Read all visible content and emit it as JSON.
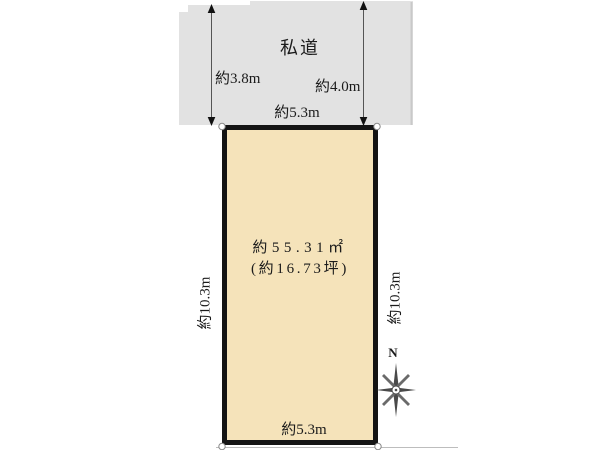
{
  "diagram": {
    "background_color": "#ffffff",
    "road": {
      "label": "私道",
      "fill_color": "#e2e2e2",
      "dim_left": "約3.8m",
      "dim_right": "約4.0m"
    },
    "plot": {
      "fill_color": "#f5e3ba",
      "border_color": "#141414",
      "area_m2": "約55.31㎡",
      "area_tsubo": "(約16.73坪)",
      "dim_top": "約5.3m",
      "dim_bottom": "約5.3m",
      "dim_left": "約10.3m",
      "dim_right": "約10.3m"
    },
    "compass": {
      "north_label": "N"
    }
  }
}
